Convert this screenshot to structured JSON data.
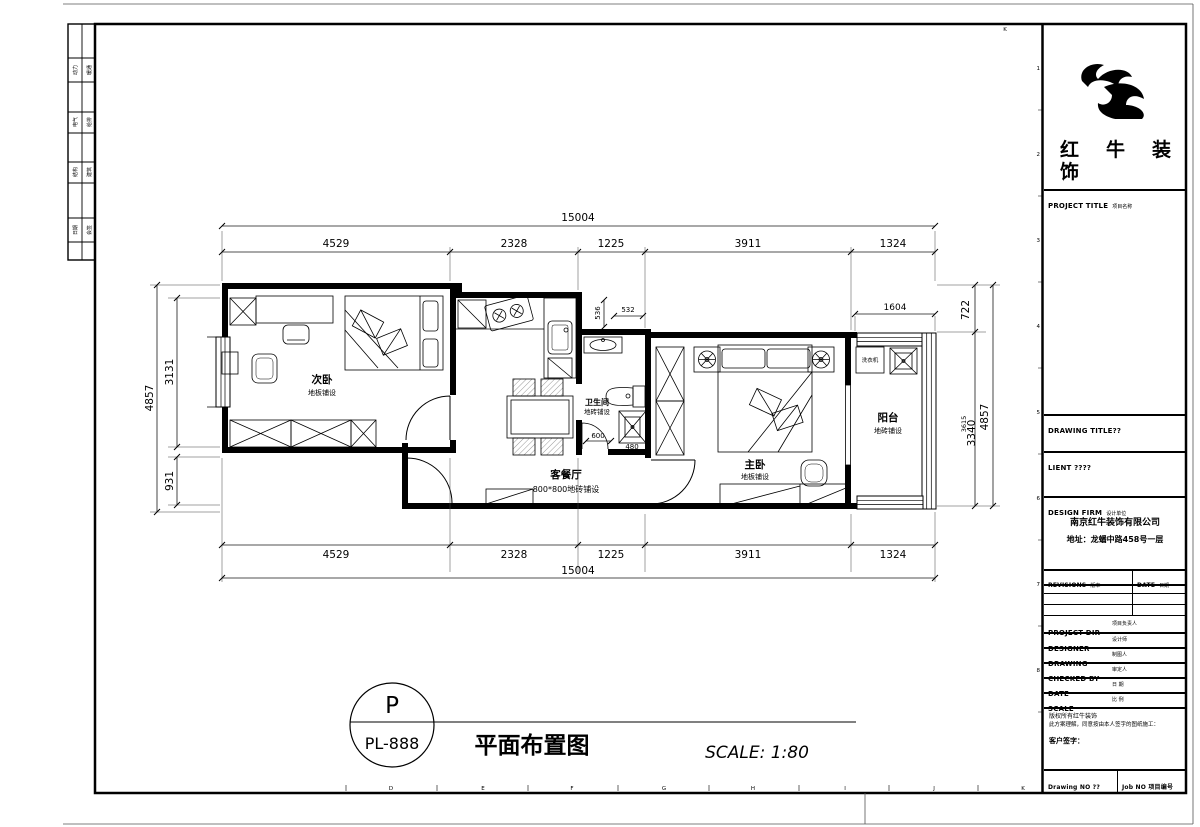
{
  "sheet": {
    "background": "#ffffff",
    "line_color": "#000000",
    "top_corner_letter": "K",
    "bottom_letters": [
      "D",
      "E",
      "F",
      "G",
      "H",
      "I",
      "J",
      "K"
    ],
    "right_numbers": [
      "1",
      "2",
      "3",
      "4",
      "5",
      "6",
      "7",
      "8"
    ]
  },
  "signature_strip": {
    "rows": [
      {
        "c1": "动力",
        "c2": "暖通"
      },
      {
        "c1": "电气",
        "c2": "给排"
      },
      {
        "c1": "结构",
        "c2": "建筑"
      },
      {
        "c1": "日期",
        "c2": "会签"
      }
    ]
  },
  "title_block": {
    "brand_line1": "红牛装",
    "brand_line2": "饰",
    "project_title_en": "PROJECT TITLE",
    "project_title_zh": "项目名称",
    "drawing_title_en": "DRAWING TITLE??",
    "client_en": "LIENT ????",
    "design_firm_en": "DESIGN FIRM",
    "design_firm_zh": "设计单位",
    "firm_name": "南京红牛装饰有限公司",
    "firm_address": "地址：龙蟠中路458号一层",
    "revisions_en": "REVISIONS",
    "revisions_zh": "版本",
    "date_col_en": "DATE",
    "date_col_zh": "日期",
    "rows": [
      {
        "en": "PROJECT DIR",
        "zh": "项目负责人"
      },
      {
        "en": "DESIGNER",
        "zh": "设计师"
      },
      {
        "en": "DRAWING",
        "zh": "制图人"
      },
      {
        "en": "CHECKED BY",
        "zh": "审定人"
      },
      {
        "en": "DATE",
        "zh": "日 期"
      },
      {
        "en": "SCALE",
        "zh": "比 例"
      }
    ],
    "copyright_line1": "版权所有红牛装饰",
    "copyright_line2": "此方案理解，同意按由本人签字的图纸施工：",
    "client_sign": "客户签字：",
    "drawing_no": "Drawing NO ??",
    "job_no": "Job NO 项目编号"
  },
  "plan": {
    "rooms": {
      "bedroom2": {
        "name": "次卧",
        "finish": "地板铺设"
      },
      "living": {
        "name": "客餐厅",
        "finish": "800*800地砖铺设"
      },
      "bathroom": {
        "name": "卫生间",
        "finish": "地砖铺设"
      },
      "master": {
        "name": "主卧",
        "finish": "地板铺设"
      },
      "balcony": {
        "name": "阳台",
        "finish": "地砖铺设"
      },
      "washer": "洗衣机"
    },
    "dims": {
      "overall_top": "15004",
      "overall_bottom": "15004",
      "top_segments": [
        "4529",
        "2328",
        "1225",
        "3911",
        "1324"
      ],
      "bottom_segments": [
        "4529",
        "2328",
        "1225",
        "3911",
        "1324"
      ],
      "left": [
        "4857",
        "3131",
        "931"
      ],
      "right": [
        "722",
        "3615",
        "3340",
        "4857"
      ],
      "balcony_top": "1604",
      "bath_niche_v": "536",
      "bath_niche_h": "532",
      "bath_w": "600",
      "shower_w": "480"
    }
  },
  "footer": {
    "bubble_top": "P",
    "bubble_bottom": "PL-888",
    "title": "平面布置图",
    "scale": "SCALE: 1:80"
  }
}
